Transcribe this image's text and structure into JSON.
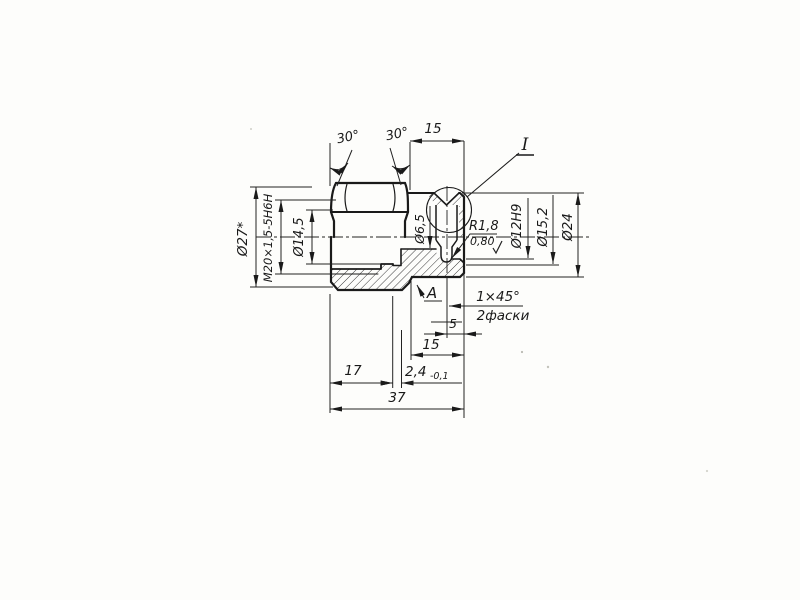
{
  "drawing": {
    "kind_label": "engineering-drawing-half-section",
    "labels": {
      "d27": "Ø27*",
      "thread": "М20×1,5-5Н6Н",
      "d145": "Ø14,5",
      "angle30_left": "30°",
      "angle30_right": "30°",
      "len15_top": "15",
      "detail_mark": "I",
      "d65": "Ø6,5",
      "r18": "R1,8",
      "roughness": "0,80",
      "d12h9": "Ø12Н9",
      "d152": "Ø15,2",
      "d24": "Ø24",
      "view_arrow": "А",
      "chamfer": "1×45°",
      "chamfer_note": "2фаски",
      "len5": "5",
      "len15_bottom": "15",
      "len17": "17",
      "len24": "2,4",
      "len24_tol": "-0,1",
      "len37": "37"
    },
    "colors": {
      "ink": "#1a1a1a",
      "paper": "#fdfdfb"
    }
  }
}
